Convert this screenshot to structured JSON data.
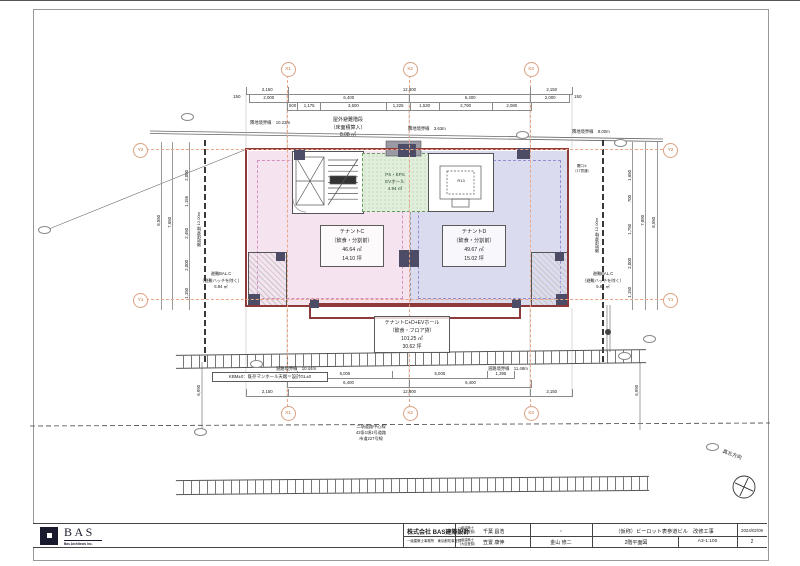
{
  "grid": {
    "x1": "X1",
    "x2": "X2",
    "x3": "X3",
    "y1": "Y1",
    "y2": "Y2"
  },
  "dims": {
    "top1": [
      "2,150",
      "12,800",
      "2,150"
    ],
    "top2": [
      "2,000",
      "6,400",
      "6,400",
      "2,000"
    ],
    "top2_left": "150",
    "top2_right": "150",
    "top3": [
      "500",
      "1,175",
      "3,500",
      "1,225",
      "1,530",
      "2,790",
      "2,080"
    ],
    "bot1": [
      "5,005",
      "5,005",
      "1,395"
    ],
    "bot2": [
      "6,400",
      "6,400"
    ],
    "bot3": [
      "2,150",
      "12,800",
      "2,150"
    ],
    "left": {
      "overall": "8,550",
      "inner": "7,650",
      "segs": [
        "2,000",
        "1,155",
        "2,450",
        "2,000",
        "1,150"
      ]
    },
    "right": {
      "overall": "8,550",
      "inner": "7,890",
      "segs": [
        "1,650",
        "700",
        "1,750",
        "2,000",
        "1,150"
      ]
    },
    "front_left": "6,990",
    "front_right": "6,990"
  },
  "boundaries": {
    "top_left": "隣地境界線　10.23m",
    "top_mid": "隣地境界線　3.63m",
    "top_right": "隣地境界線　8.00m",
    "side_left": "隣地境界線 12.00m",
    "side_right": "隣地境界線 12.00m",
    "road_left": "道路境界線　10.44m",
    "road_right": "道路境界線　11.48m",
    "road_center_l1": "二項道路中心線",
    "road_center_l2": "42条1項1号道路",
    "road_center_l3": "市道227号線"
  },
  "rooms": {
    "tenant_c": {
      "name": "テナントC",
      "use": "（飲食・分割前）",
      "area": "46.64 ㎡",
      "tsubo": "14.10 坪"
    },
    "tenant_d": {
      "name": "テナントD",
      "use": "（飲食・分割前）",
      "area": "49.67 ㎡",
      "tsubo": "15.02 坪"
    },
    "combined": {
      "name": "テナントC+D+EVホール",
      "use": "（飲食・フロア貸）",
      "area": "101.25 ㎡",
      "tsubo": "30.62 坪"
    },
    "ps_hall": {
      "l1": "PS・EPS",
      "l2": "EVホール",
      "l3": "4.94 ㎡"
    },
    "ev": "R13"
  },
  "notes": {
    "stair_l1": "屋外避難階段",
    "stair_l2": "（床面積算入）",
    "stair_l3": "8.08 ㎡",
    "balcony_l1": "避難BAL.C",
    "balcony_l2": "（避難ハッチを除く）",
    "balcony_l3": "5.84 ㎡",
    "opening_l1": "開口①",
    "opening_l2": "（1T貫通）",
    "kbm": "KBM±0：既存マンホール天端＝設計GL±0",
    "north": "真北方向"
  },
  "title_block": {
    "logo": "BAS",
    "logo_sub": "Bas Architects Inc.",
    "firm": "株式会社 BAS建築設計",
    "firm_reg": "一級建築士事務所　東京都知事登録",
    "role": "一級建築士",
    "role_reg": "（大臣登録）",
    "architect1": "千葉 昌浩",
    "architect2": "笠置 康伸",
    "checked": "金山 修二",
    "dot": "・",
    "project": "（仮称）ビーロット表参道ビル　改修工事",
    "drawing": "2階平面図",
    "scale": "A3-1:100",
    "date": "2024/02/09",
    "sheet": "2"
  },
  "colors": {
    "wall": "#8e3a3a",
    "grid": "#e8a888",
    "tenant_c": "#f6e3f0",
    "tenant_d": "#dbdbf0",
    "hall": "#e0eedb"
  }
}
